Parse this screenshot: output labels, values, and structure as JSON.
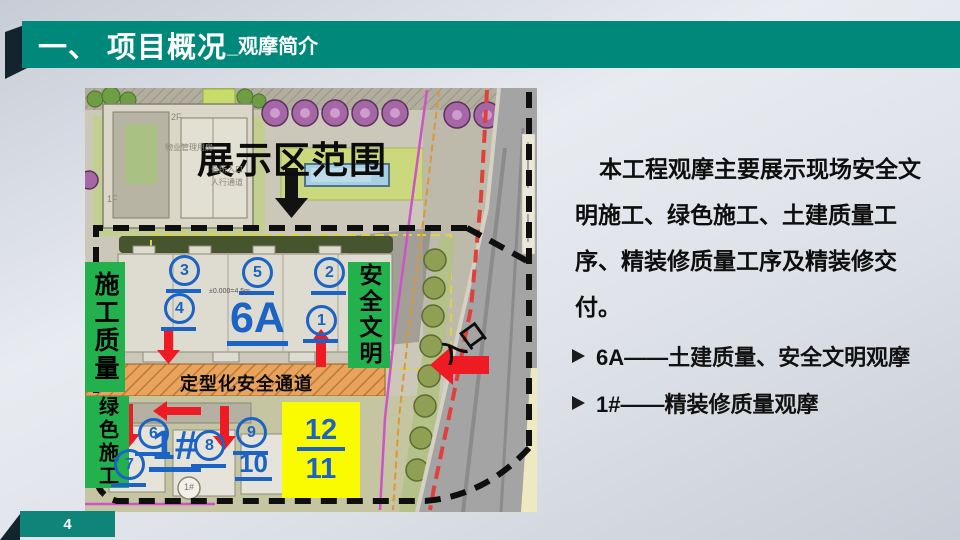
{
  "header": {
    "title_main": "一、 项目概况",
    "title_sub": "_观摩简介"
  },
  "footer": {
    "page_number": "4"
  },
  "map": {
    "banner": "展示区范围",
    "labels": {
      "construction_quality": "施工质量",
      "green_construction": "绿色施工",
      "safety_civilization": "安全文明",
      "safety_channel": "定型化安全通道",
      "entrance": "入口",
      "building_6a": "6A",
      "building_1": "1#"
    },
    "markers": {
      "m1": "1",
      "m2": "2",
      "m3": "3",
      "m4": "4",
      "m5": "5",
      "m6": "6",
      "m7": "7",
      "m8": "8",
      "m9": "9",
      "m10": "10"
    },
    "yellow_box": {
      "top": "12",
      "bottom": "11"
    },
    "plan_texts": {
      "floor_2f": "2F",
      "floor_1f": "1F",
      "property_mgmt": "物业管理用房",
      "club_entrance": "会所入口",
      "pedestrian_walk": "人行通道",
      "elevation": "±0.000=4.5m",
      "building_1_circle": "1#"
    }
  },
  "content": {
    "paragraph_lines": [
      "本工程观摩主要展示现场安全文",
      "明施工、绿色施工、土建质量工",
      "序、精装修质量工序及精装修交",
      "付。"
    ],
    "bullets": [
      {
        "text": "6A——土建质量、安全文明观摩"
      },
      {
        "text": "1#——精装修质量观摩"
      }
    ]
  },
  "colors": {
    "header_teal": "#00897b",
    "annotation_blue": "#1b63c5",
    "marker_green": "#22b14c",
    "arrow_red": "#ee1b24",
    "highlight_yellow": "#fbfb00",
    "channel_orange": "#e8a45e"
  }
}
